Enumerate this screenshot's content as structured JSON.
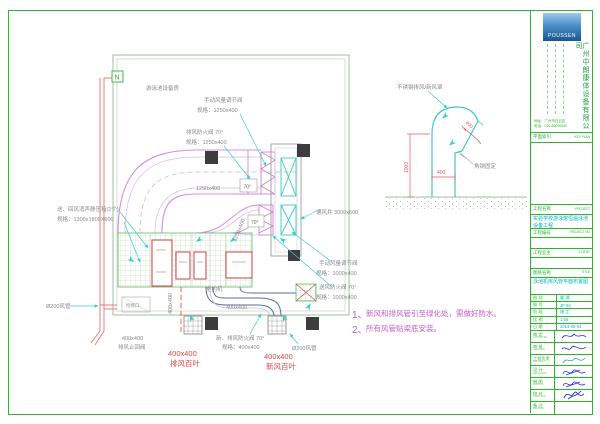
{
  "plan": {
    "room_name": "游泳池设备房",
    "marker": "N",
    "ann": {
      "manual_damper1_1": "手动风量调节阀",
      "manual_damper1_2": "规格：1250x400",
      "exhaust_fire_damper_1": "排风防火阀 70°",
      "exhaust_fire_damper_2": "规格：1250x400",
      "duct_dim_main": "1250x400",
      "duct_dim_main_v": "1250x400",
      "deg1": "70°",
      "deg2": "70°",
      "plenum_1": "送、回风消声静压箱(2个)",
      "plenum_2": "规格：1300x1800X600",
      "shaft": "通风井 3000x600",
      "manual_damper2_1": "手动风量调节阀",
      "manual_damper2_2": "规格：1000x400",
      "supply_fire_damper_1": "送风防火阀 70°",
      "supply_fire_damper_2": "规格：1000x400",
      "indoor_unit": "室内机",
      "duct_dim_400": "400x400",
      "duct_dim_400_v": "400x400",
      "access": "检修口",
      "check_valve_1": "400x400",
      "check_valve_2": "排风止回阀",
      "fresh_exhaust_damper_1": "新、排风防火阀 70°",
      "fresh_exhaust_damper_2": "规格：400x400",
      "pipe_left": "Ø200风管",
      "pipe_bottom": "Ø200风管",
      "louver_exh_1": "400x400",
      "louver_exh_2": "排风百叶",
      "louver_fresh_1": "400x400",
      "louver_fresh_2": "新风百叶"
    },
    "notes": [
      {
        "num": "1、",
        "text": "新风和排风管引至绿化处，需做好防水。"
      },
      {
        "num": "2、",
        "text": "所有风管贴梁底安装。"
      }
    ]
  },
  "detail": {
    "hood": "不锈钢排风/新风罩",
    "fix": "角钢固定",
    "dim_h": "1000",
    "dim_w": "400",
    "dim_open": "400"
  },
  "tb": {
    "logo": "POUSSEN",
    "company": "广州中朗康体设备有限公司",
    "contact1": "地址：广州市白云区",
    "contact2": "电话：020-86000000",
    "keyplan_label": "平面索引",
    "keyplan_en": "KEY PLAN",
    "project_label": "工程名称",
    "project_en": "PROJECT",
    "project_name": "实验学校游泳馆恒温泳池设备工程",
    "projno_label": "工程编号",
    "projno_en": "PROJECT NO",
    "client_label": "工程业主",
    "client_en": "CLIENT",
    "title_label": "图纸名称",
    "title_en": "TITLE",
    "drawing_title": "泳池机房风管平面布置图",
    "small_rows": [
      {
        "label": "图 别",
        "value": "暖 通"
      },
      {
        "label": "图 号",
        "value": "JF-03"
      },
      {
        "label": "阶 段",
        "value": "施 工"
      },
      {
        "label": "比 例",
        "value": "1:50"
      },
      {
        "label": "日 期",
        "value": "2013-09-04"
      }
    ],
    "sign_rows": [
      {
        "label": "审 定",
        "en": "APPROVED"
      },
      {
        "label": "审 核",
        "en": "VERIFIED"
      },
      {
        "label": "工程负责",
        "en": "PROJECT"
      },
      {
        "label": "设 计",
        "en": "DESIGNED"
      },
      {
        "label": "制 图",
        "en": "DRAWN"
      },
      {
        "label": "校 对",
        "en": "CHECKED"
      },
      {
        "label": "备 注",
        "en": "REMARK"
      }
    ]
  },
  "colors": {
    "frame_green": "#2db52d",
    "duct_magenta": "#d98cd9",
    "cyan": "#35cfcf",
    "dim_red": "#e05c5c",
    "note_magenta": "#c05fc0",
    "value_cyan": "#00b5b5"
  }
}
